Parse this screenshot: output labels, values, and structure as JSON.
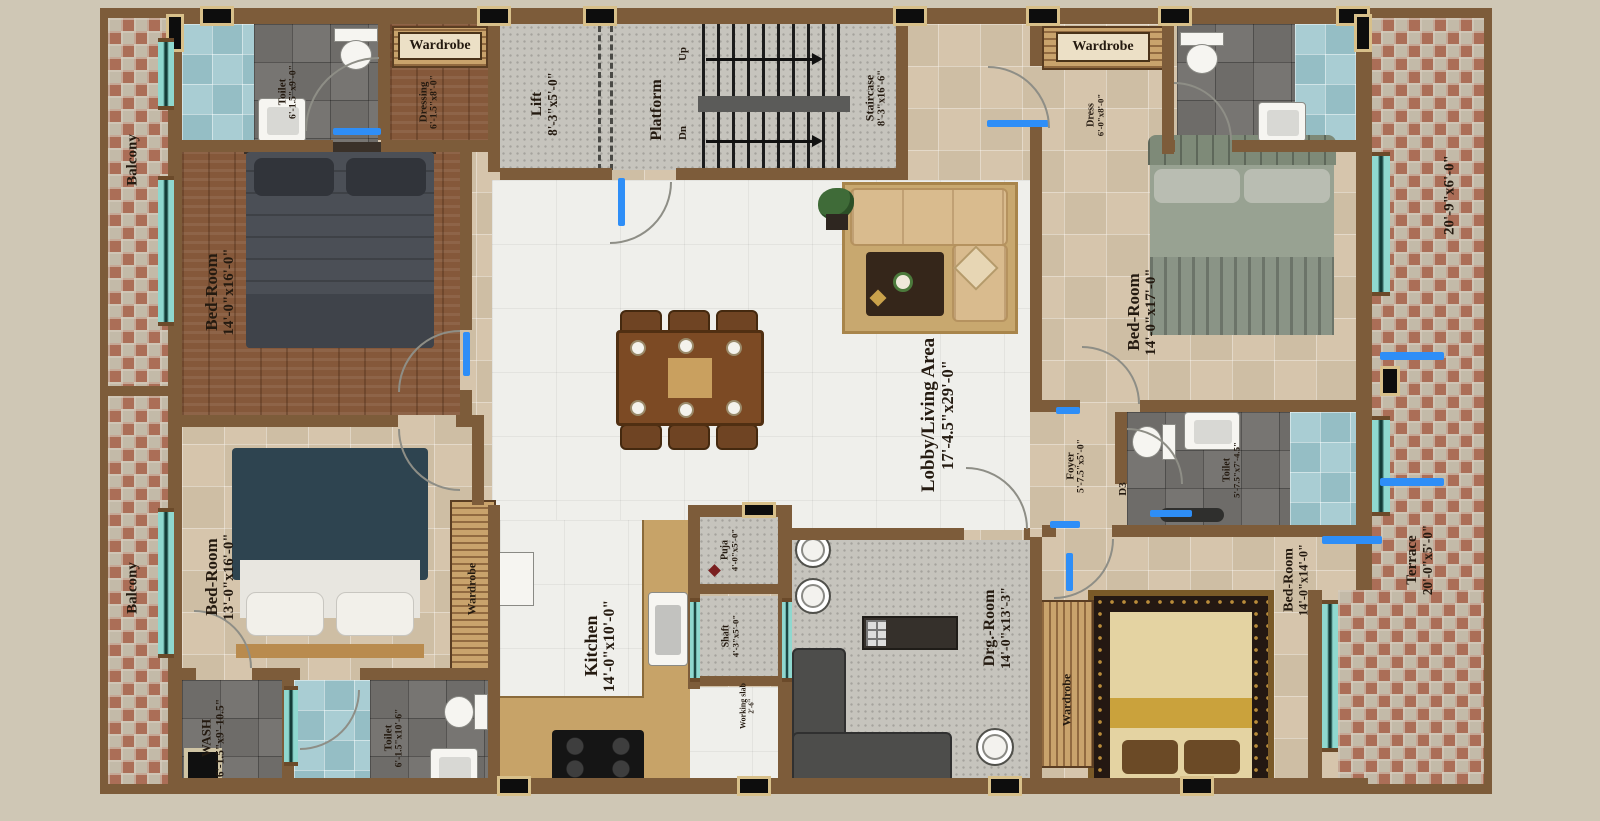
{
  "plan": {
    "balcony_top": {
      "name": "Balcony"
    },
    "balcony_bottom": {
      "name": "Balcony"
    },
    "toilet_top_left": {
      "name": "Toilet",
      "dims": "6'-1.5\"x9'-0\""
    },
    "wardrobe_top_left": {
      "name": "Wardrobe"
    },
    "dressing_top_left": {
      "name": "Dressing",
      "dims": "6'-1.5\"x8'-0\""
    },
    "lift": {
      "name": "Lift",
      "dims": "8'-3\"x5'-0\""
    },
    "platform": {
      "name": "Platform"
    },
    "staircase": {
      "name": "Staircase",
      "dims": "8'-3\"x16'-6\"",
      "up": "Up",
      "dn": "Dn"
    },
    "wardrobe_top_right": {
      "name": "Wardrobe"
    },
    "dress_top_right": {
      "name": "Dress",
      "dims": "6'-0\"x8'-0\""
    },
    "bedroom_top_left": {
      "name": "Bed-Room",
      "dims": "14'-0\"x16'-0\""
    },
    "bedroom_top_right": {
      "name": "Bed-Room",
      "dims": "14'-0\"x17'-0\""
    },
    "bedroom_bottom_left": {
      "name": "Bed-Room",
      "dims": "13'-0\"x16'-0\""
    },
    "bedroom_bottom_right": {
      "name": "Bed-Room",
      "dims": "14'-0\"x14'-0\""
    },
    "wardrobe_bottom_left": {
      "name": "Wardrobe"
    },
    "wardrobe_bottom_right": {
      "name": "Wardrobe"
    },
    "lobby_living": {
      "name": "Lobby/Living Area",
      "dims": "17'-4.5\"x29'-0\""
    },
    "kitchen": {
      "name": "Kitchen",
      "dims": "14'-0\"x10'-0\""
    },
    "puja": {
      "name": "Puja",
      "dims": "4'-0\"x5'-0\""
    },
    "shaft": {
      "name": "Shaft",
      "dims": "4'-3\"x5'-0\""
    },
    "working_slab": {
      "name": "Working slab",
      "dims": "2'-6\""
    },
    "drawing_room": {
      "name": "Drg.-Room",
      "dims": "14'-0\"x13'-3\""
    },
    "foyer": {
      "name": "Foyer",
      "dims": "5'-7.5\"x5'-0\""
    },
    "door_d3": {
      "name": "D3"
    },
    "toilet_right": {
      "name": "Toilet",
      "dims": "5'-7.5\"x7'-4.5\""
    },
    "wash": {
      "name": "WASH",
      "dims": "6'-1.5\"x9'-10.5\""
    },
    "toilet_bottom_left": {
      "name": "Toilet",
      "dims": "6'-1.5\"x10'-6\""
    },
    "terrace_upper": {
      "dims": "20'-9\"x6'-0\""
    },
    "terrace": {
      "name": "Terrace",
      "dims": "20'-0\"x5'-0\""
    }
  },
  "colors": {
    "background": "#cfc7b5",
    "wall": "#7d5c3a",
    "brick": "#ab6e57",
    "wood_floor": "#85583a",
    "beige_tile": "#d6c5ac",
    "gray_tile": "#6e6c69",
    "aqua_tile": "#a9cdd3",
    "window_teal": "#8fd8cf",
    "door_marker_blue": "#2e8ef7",
    "label_text": "#241a10"
  }
}
